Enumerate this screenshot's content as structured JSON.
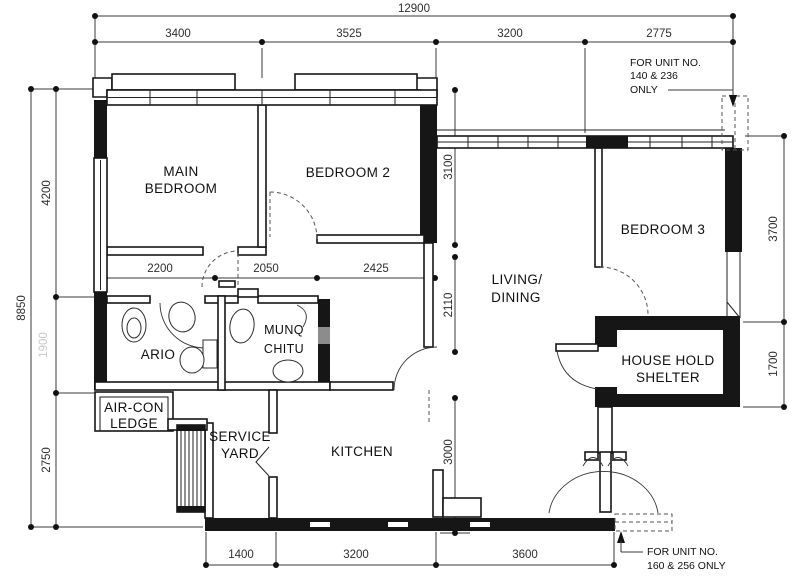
{
  "dims": {
    "overall_width": "12900",
    "top": [
      "3400",
      "3525",
      "3200",
      "2775"
    ],
    "left_overall": "8850",
    "left": [
      "4200",
      "1900",
      "2750"
    ],
    "right": [
      "3700",
      "1700"
    ],
    "bottom": [
      "1400",
      "3200",
      "3600"
    ],
    "corridor": [
      "2200",
      "2050",
      "2425"
    ],
    "vertical": [
      "3100",
      "2110",
      "3000"
    ]
  },
  "rooms": {
    "main_bedroom": [
      "MAIN",
      "BEDROOM"
    ],
    "bedroom2": "BEDROOM 2",
    "bedroom3": "BEDROOM 3",
    "living": [
      "LIVING/",
      "DINING"
    ],
    "kitchen": "KITCHEN",
    "service_yard": [
      "SERVICE",
      "YARD"
    ],
    "aircon_ledge": [
      "AIR-CON",
      "LEDGE"
    ],
    "household_shelter": [
      "HOUSE HOLD",
      "SHELTER"
    ],
    "bath1": "ARIO",
    "bath2": [
      "MUNQ",
      "CHITU"
    ]
  },
  "notes": {
    "unit_top": [
      "FOR  UNIT NO.",
      "140 & 236",
      "ONLY"
    ],
    "unit_bottom": [
      "FOR  UNIT NO.",
      "160 & 256 ONLY"
    ]
  },
  "colors": {
    "wall": "#161616",
    "dim": "#2e2e2e",
    "faded": "#c9c9c9",
    "window_grey": "#8c8c8c"
  }
}
